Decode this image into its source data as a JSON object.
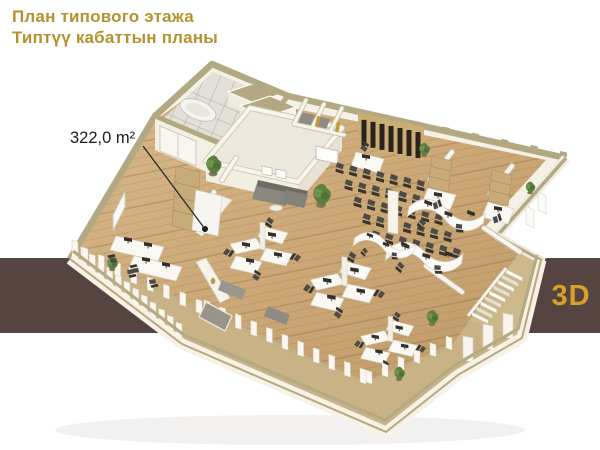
{
  "page": {
    "background_color": "#ffffff"
  },
  "header": {
    "title_line1": "План типового этажа",
    "title_line2": "Типтүү кабаттын планы",
    "text_color": "#b3922f"
  },
  "floor_plan": {
    "area_label": "322,0 m²",
    "label_color": "#1c1c1c",
    "illustration": "isometric-3d-office-floor-plan"
  },
  "banner_3d": {
    "label": "3D",
    "text_color": "#d7a02b",
    "background_color": "#564441"
  },
  "palette": {
    "wall_white": "#f5f1e6",
    "coping_tan": "#b2a982",
    "wood_floor": "#cdab7c",
    "deck_tan": "#c8b286",
    "tile_floor": "#e2e0d9",
    "slat_wall_dark": "#2a221b",
    "furniture_dark": "#4e4a45",
    "sofa_gray": "#8b8780",
    "shelf_wood": "#c7ab79",
    "plant_green": "#5c7e40"
  }
}
